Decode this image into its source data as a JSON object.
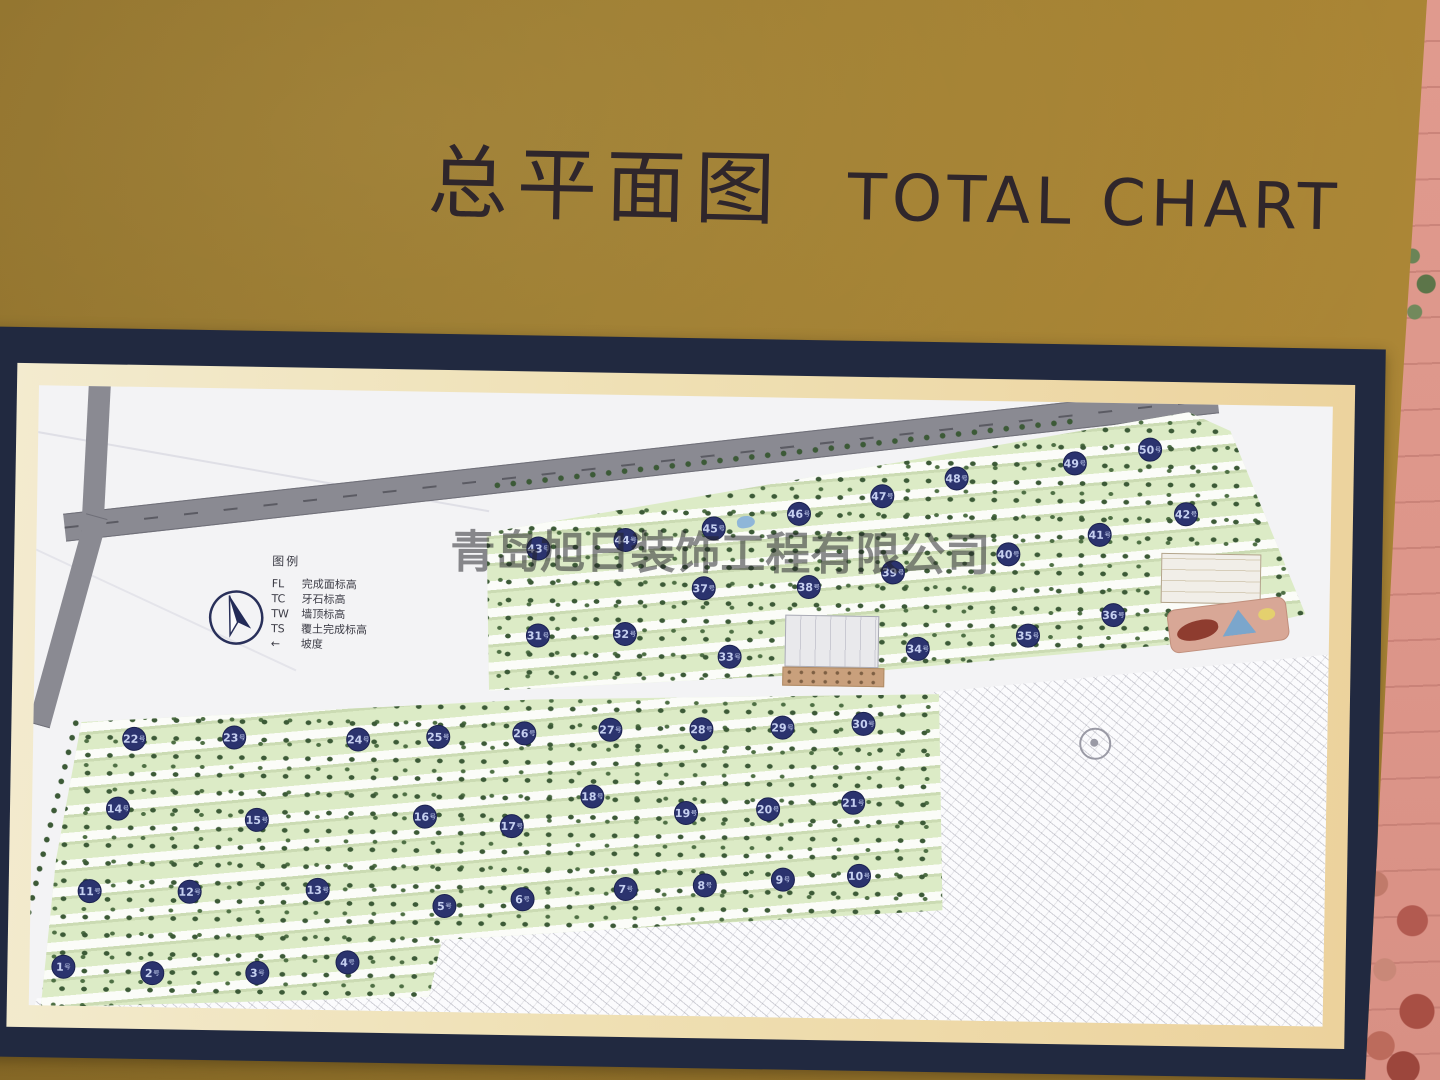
{
  "sign": {
    "title_zh": "总平面图",
    "title_en": "TOTAL CHART",
    "watermark": "青岛旭日装饰工程有限公司"
  },
  "legend": {
    "title": "图例",
    "items": [
      {
        "abbr": "FL",
        "label": "完成面标高"
      },
      {
        "abbr": "TC",
        "label": "牙石标高"
      },
      {
        "abbr": "TW",
        "label": "墙顶标高"
      },
      {
        "abbr": "TS",
        "label": "覆土完成标高"
      },
      {
        "abbr": "←",
        "label": "坡度"
      }
    ]
  },
  "map": {
    "building_suffix": "号",
    "badge_color": "#2b336e",
    "badge_text_color": "#c6d0f0",
    "buildings": [
      {
        "no": "1",
        "x": 34,
        "y": 581
      },
      {
        "no": "2",
        "x": 123,
        "y": 586
      },
      {
        "no": "3",
        "x": 228,
        "y": 584
      },
      {
        "no": "4",
        "x": 318,
        "y": 572
      },
      {
        "no": "5",
        "x": 414,
        "y": 514
      },
      {
        "no": "6",
        "x": 492,
        "y": 506
      },
      {
        "no": "7",
        "x": 595,
        "y": 494
      },
      {
        "no": "8",
        "x": 674,
        "y": 489
      },
      {
        "no": "9",
        "x": 752,
        "y": 482
      },
      {
        "no": "10",
        "x": 828,
        "y": 477
      },
      {
        "no": "11",
        "x": 59,
        "y": 505
      },
      {
        "no": "12",
        "x": 159,
        "y": 504
      },
      {
        "no": "13",
        "x": 287,
        "y": 500
      },
      {
        "no": "14",
        "x": 86,
        "y": 422
      },
      {
        "no": "15",
        "x": 225,
        "y": 431
      },
      {
        "no": "16",
        "x": 393,
        "y": 425
      },
      {
        "no": "17",
        "x": 480,
        "y": 433
      },
      {
        "no": "18",
        "x": 560,
        "y": 402
      },
      {
        "no": "19",
        "x": 654,
        "y": 417
      },
      {
        "no": "20",
        "x": 736,
        "y": 412
      },
      {
        "no": "21",
        "x": 821,
        "y": 404
      },
      {
        "no": "22",
        "x": 101,
        "y": 352
      },
      {
        "no": "23",
        "x": 201,
        "y": 349
      },
      {
        "no": "24",
        "x": 325,
        "y": 349
      },
      {
        "no": "25",
        "x": 405,
        "y": 345
      },
      {
        "no": "26",
        "x": 491,
        "y": 340
      },
      {
        "no": "27",
        "x": 577,
        "y": 335
      },
      {
        "no": "28",
        "x": 668,
        "y": 333
      },
      {
        "no": "29",
        "x": 749,
        "y": 330
      },
      {
        "no": "30",
        "x": 830,
        "y": 325
      },
      {
        "no": "31",
        "x": 503,
        "y": 242
      },
      {
        "no": "32",
        "x": 590,
        "y": 239
      },
      {
        "no": "33",
        "x": 695,
        "y": 260
      },
      {
        "no": "34",
        "x": 883,
        "y": 249
      },
      {
        "no": "35",
        "x": 993,
        "y": 234
      },
      {
        "no": "36",
        "x": 1078,
        "y": 212
      },
      {
        "no": "37",
        "x": 668,
        "y": 192
      },
      {
        "no": "38",
        "x": 773,
        "y": 189
      },
      {
        "no": "39",
        "x": 857,
        "y": 173
      },
      {
        "no": "40",
        "x": 972,
        "y": 153
      },
      {
        "no": "41",
        "x": 1063,
        "y": 132
      },
      {
        "no": "42",
        "x": 1149,
        "y": 110
      },
      {
        "no": "43",
        "x": 502,
        "y": 155
      },
      {
        "no": "44",
        "x": 589,
        "y": 145
      },
      {
        "no": "45",
        "x": 677,
        "y": 132
      },
      {
        "no": "46",
        "x": 762,
        "y": 116
      },
      {
        "no": "47",
        "x": 845,
        "y": 97
      },
      {
        "no": "48",
        "x": 919,
        "y": 78
      },
      {
        "no": "49",
        "x": 1037,
        "y": 61
      },
      {
        "no": "50",
        "x": 1112,
        "y": 46
      }
    ]
  },
  "colors": {
    "board_gold": "#a07c30",
    "frame_navy": "#212940",
    "mat_cream": "#eedfb4",
    "paper": "#f3f3f5",
    "road_gray": "#8a8a92",
    "green_band": "#dcebc6",
    "tree_green": "#3c5a37",
    "wall_pink": "#dd968a",
    "bush_green": "#35512c"
  }
}
